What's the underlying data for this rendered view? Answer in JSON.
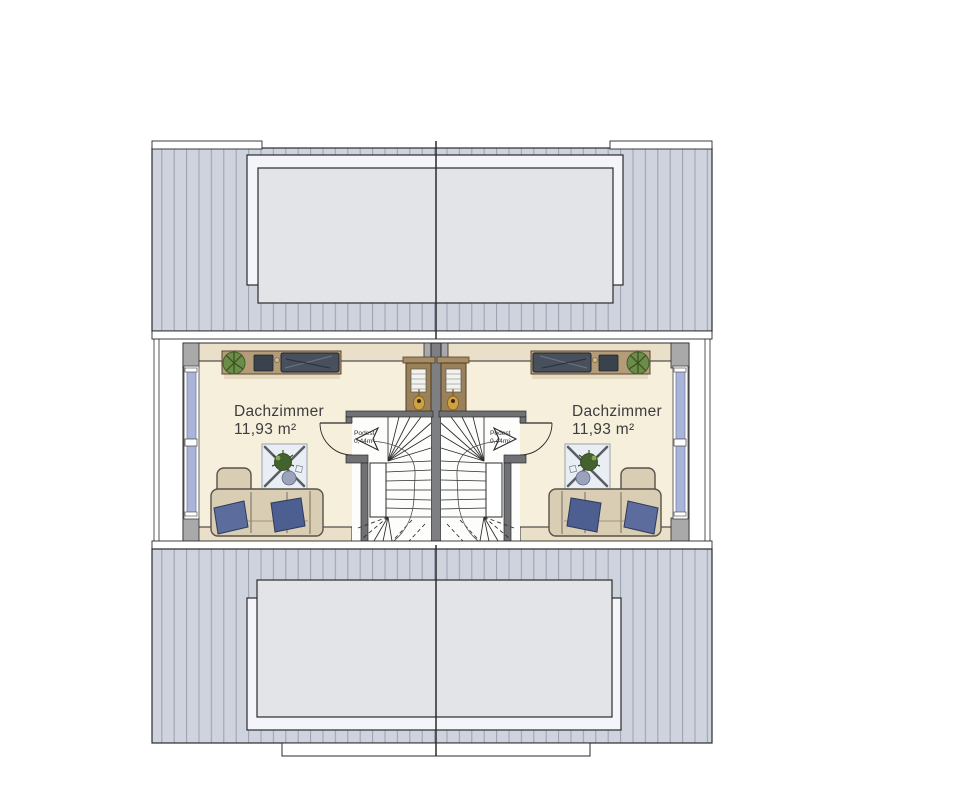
{
  "floorplan": {
    "type": "attic-floor-plan-duplex",
    "rooms": [
      {
        "label": "Dachzimmer",
        "area": "11,93 m²"
      },
      {
        "label": "Dachzimmer",
        "area": "11,93 m²"
      }
    ],
    "landings": [
      {
        "label": "Podest",
        "area": "0,44m²"
      },
      {
        "label": "Podest",
        "area": "0,44m²"
      }
    ],
    "colors": {
      "roof_hatch_fill": "#ced3dd",
      "roof_hatch_line": "#99a0af",
      "dormer_frame": "#f3f5fa",
      "dormer_roof": "#e3e4e7",
      "floor": "#f6efdc",
      "exterior_wall": "#eadfc9",
      "wall_post": "#a9a9a9",
      "party_wall": "#7d7f83",
      "window_glass": "#a9b4d8",
      "wood_furniture": "#b49c78",
      "sofa": "#d9cdb4",
      "pillow": "#5c6c9c",
      "tv_dark": "#47505c",
      "plant_green": "#44622e",
      "outline": "#2b2b2b"
    }
  }
}
